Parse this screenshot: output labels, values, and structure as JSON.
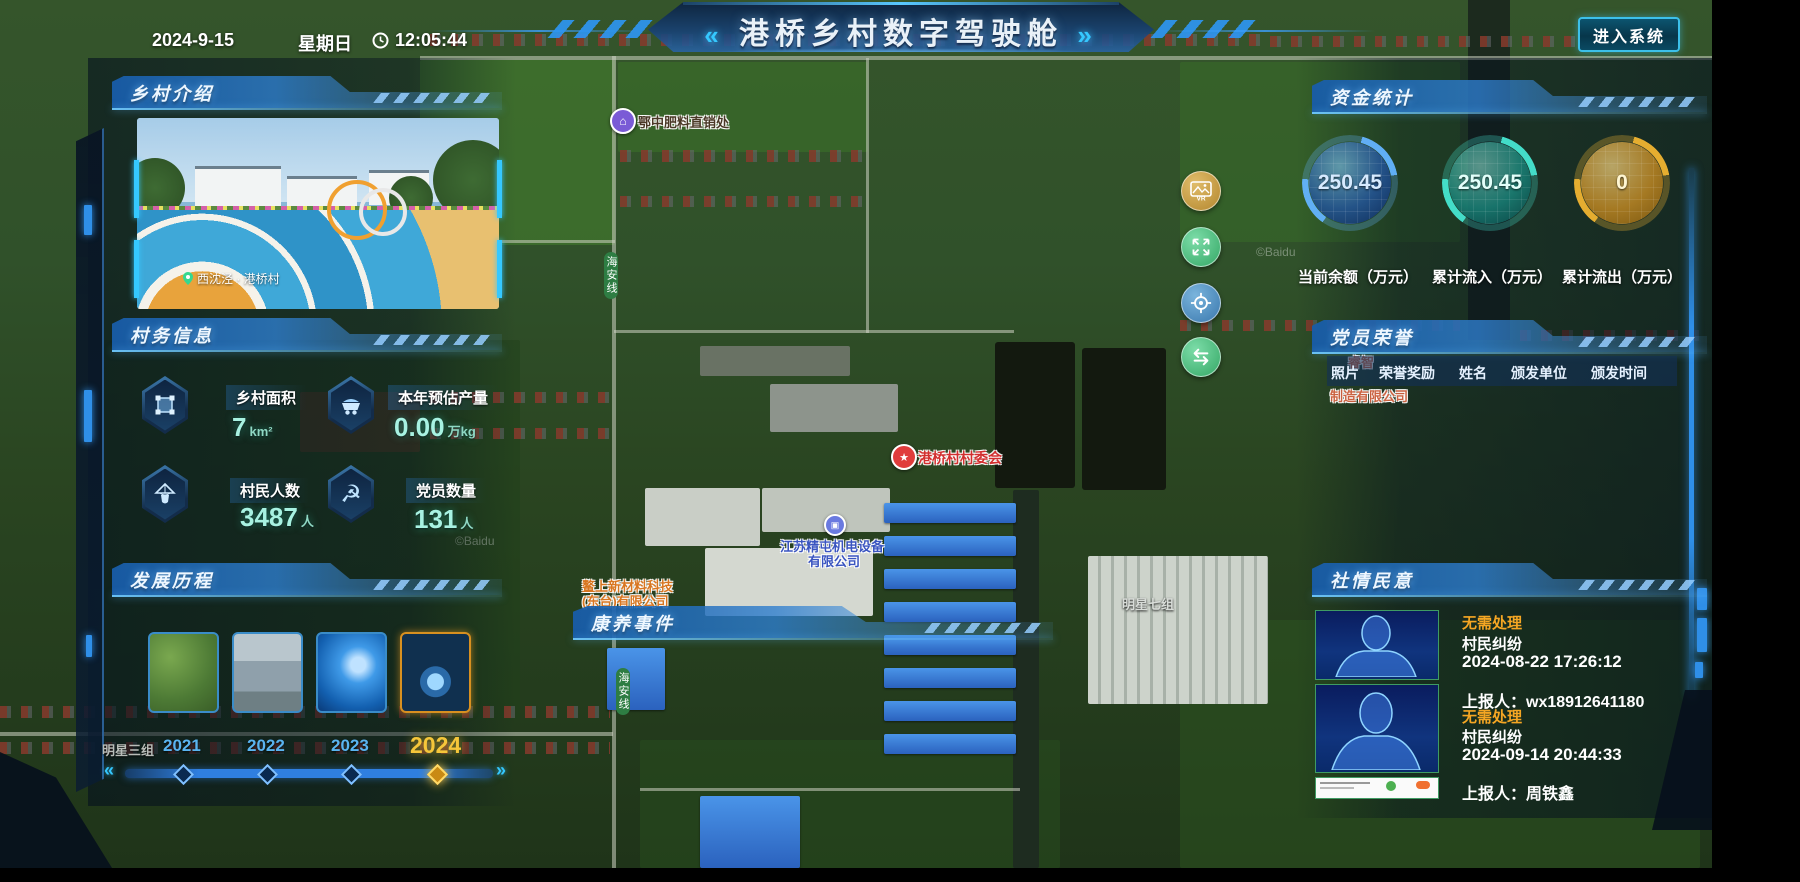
{
  "topbar": {
    "date": "2024-9-15",
    "weekday": "星期日",
    "time": "12:05:44",
    "title": "港桥乡村数字驾驶舱",
    "title_prefix": "«",
    "title_suffix": "»",
    "enter_button": "进入系统"
  },
  "intro": {
    "header": "乡村介绍",
    "photo_caption": "西沈泾 · 港桥村"
  },
  "affairs": {
    "header": "村务信息",
    "stats": [
      {
        "icon": "area-icon",
        "label": "乡村面积",
        "value": "7",
        "unit": "km²"
      },
      {
        "icon": "cart-icon",
        "label": "本年预估产量",
        "value": "0.00",
        "unit": "万kg"
      },
      {
        "icon": "villager-icon",
        "label": "村民人数",
        "value": "3487",
        "unit": "人"
      },
      {
        "icon": "party-icon",
        "label": "党员数量",
        "value": "131",
        "unit": "人"
      }
    ]
  },
  "history": {
    "header": "发展历程",
    "years": [
      {
        "label": "2021",
        "selected": false
      },
      {
        "label": "2022",
        "selected": false
      },
      {
        "label": "2023",
        "selected": false
      },
      {
        "label": "2024",
        "selected": true
      }
    ],
    "prev_arrow": "«",
    "next_arrow": "»"
  },
  "funds": {
    "header": "资金统计",
    "gauges": [
      {
        "value": "250.45",
        "label": "当前余额（万元）",
        "color": "#4da0e0"
      },
      {
        "value": "250.45",
        "label": "累计流入（万元）",
        "color": "#38d8c8"
      },
      {
        "value": "0",
        "label": "累计流出（万元）",
        "color": "#e8b83a"
      }
    ]
  },
  "honors": {
    "header": "党员荣誉",
    "columns": [
      "照片",
      "荣誉奖励",
      "姓名",
      "颁发单位",
      "颁发时间"
    ]
  },
  "sentiment": {
    "header": "社情民意",
    "items": [
      {
        "status": "无需处理",
        "category": "村民纠纷",
        "time": "2024-08-22 17:26:12",
        "reporter": "上报人：wx18912641180"
      },
      {
        "status": "无需处理",
        "category": "村民纠纷",
        "time": "2024-09-14 20:44:33",
        "reporter": "上报人：周铁鑫"
      }
    ]
  },
  "health": {
    "header": "康养事件"
  },
  "controls": {
    "vr_label": "VR"
  },
  "map_labels": {
    "fertilizer": "鄂中肥料直销处",
    "committee": "港桥村村委会",
    "company1_line1": "江苏精屯机电设备",
    "company1_line2": "有限公司",
    "company2_line1": "鳌上新材料科技",
    "company2_line2": "(东台)有限公司",
    "company3_line1": "睿智",
    "company3_line2": "制造有限公司",
    "group7": "明星七组",
    "group3": "明星三组",
    "road_badge": "海安线",
    "watermark": "©Baidu"
  }
}
